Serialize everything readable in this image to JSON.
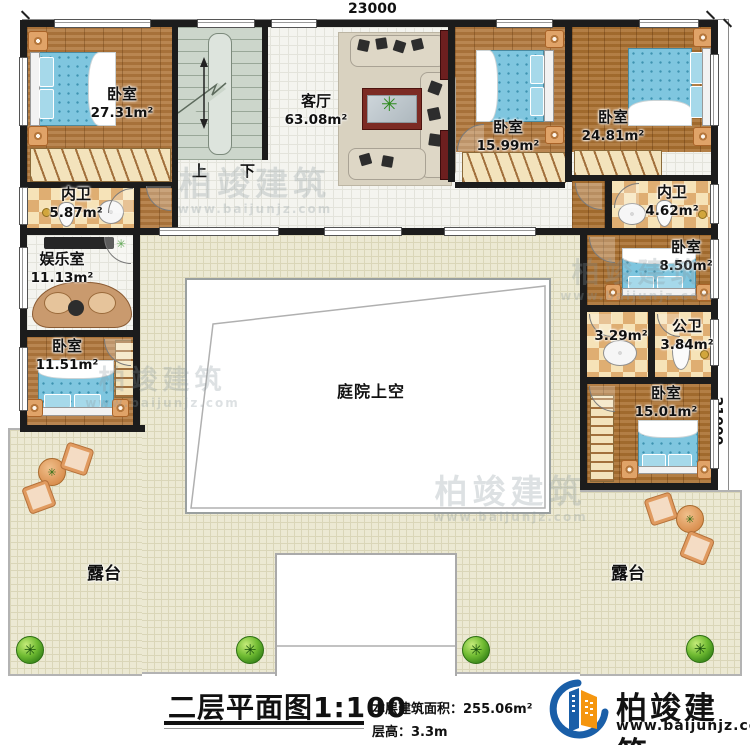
{
  "dimensions": {
    "top": "23000",
    "right": "21000"
  },
  "rooms": {
    "bedroom_tl": {
      "name": "卧室",
      "area": "27.31m²"
    },
    "living": {
      "name": "客厅",
      "area": "63.08m²"
    },
    "bedroom_tm": {
      "name": "卧室",
      "area": "15.99m²"
    },
    "bedroom_tr": {
      "name": "卧室",
      "area": "24.81m²"
    },
    "bath_left": {
      "name": "内卫",
      "area": "5.87m²"
    },
    "bath_right": {
      "name": "内卫",
      "area": "4.62m²"
    },
    "entertainment": {
      "name": "娱乐室",
      "area": "11.13m²"
    },
    "bedroom_ml": {
      "name": "卧室",
      "area": "11.51m²"
    },
    "bedroom_mr": {
      "name": "卧室",
      "area": "8.50m²"
    },
    "wash": {
      "area": "3.29m²"
    },
    "public_bath": {
      "name": "公卫",
      "area": "3.84m²"
    },
    "bedroom_br": {
      "name": "卧室",
      "area": "15.01m²"
    },
    "courtyard": {
      "name": "庭院上空"
    },
    "terrace_left": {
      "name": "露台"
    },
    "terrace_right": {
      "name": "露台"
    }
  },
  "stairs": {
    "up": "上",
    "down": "下"
  },
  "titleblock": {
    "title": "二层平面图1:100",
    "area_label": "本层建筑面积：255.06m²",
    "height_label": "层高：3.3m"
  },
  "logo": {
    "name": "柏竣建筑",
    "url": "www.baijunjz.com"
  },
  "watermark": {
    "text": "柏竣建筑",
    "sub": "www.baijunjz.com"
  },
  "icons": {
    "plant": "✳"
  },
  "colors": {
    "wall": "#1c1c1c",
    "wood_floor": "#b1783d",
    "tile_floor": "#f4f4ef",
    "terrace_floor": "#ece9d3",
    "bathroom_tile": "#e8c08a",
    "bed_blue": "#7fc6df",
    "stairs": "#ccd6cb",
    "logo_blue": "#1a5fa8",
    "logo_orange": "#f5960f"
  }
}
